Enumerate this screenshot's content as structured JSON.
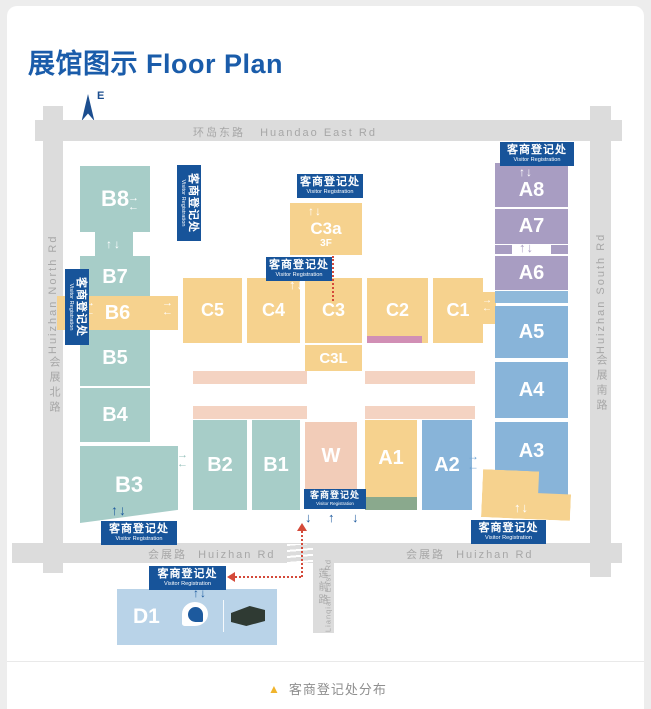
{
  "title": "展馆图示 Floor Plan",
  "compass": {
    "label": "E"
  },
  "roads": {
    "huandao": {
      "zh": "环岛东路",
      "en": "Huandao East Rd"
    },
    "huizhan_north": {
      "zh": "会展北路",
      "en": "Huizhan North Rd"
    },
    "huizhan_south": {
      "zh": "会展南路",
      "en": "Huizhan South Rd"
    },
    "huizhan": {
      "zh": "会展路",
      "en": "Huizhan Rd"
    },
    "lianqian": {
      "zh": "莲前路",
      "en": "Lianqian East Rd"
    }
  },
  "registration": {
    "zh": "客商登记处",
    "en": "Visitor Registration"
  },
  "halls": {
    "B8": "B8",
    "B7": "B7",
    "B6": "B6",
    "B5": "B5",
    "B4": "B4",
    "B3": "B3",
    "B2": "B2",
    "B1": "B1",
    "C5": "C5",
    "C4": "C4",
    "C3": "C3",
    "C2": "C2",
    "C1": "C1",
    "C3a": "C3a",
    "C3a_floor": "3F",
    "C3L": "C3L",
    "A8": "A8",
    "A7": "A7",
    "A6": "A6",
    "A5": "A5",
    "A4": "A4",
    "A3": "A3",
    "A2": "A2",
    "A1": "A1",
    "W": "W",
    "D1": "D1"
  },
  "icons": {
    "up": "↑",
    "down": "↓",
    "left": "←",
    "right": "→",
    "up_down": "↑↓",
    "legend_marker": "▲"
  },
  "legend": {
    "text": "客商登记处分布"
  },
  "colors": {
    "title_blue": "#1a5caa",
    "badge_blue": "#17549a",
    "teal": "#a7cdc8",
    "yellow": "#f6d28e",
    "purple": "#a89dc2",
    "blue": "#88b4d9",
    "salmon": "#f2ccb8",
    "light_blue_d1": "#b9d3e8",
    "road_gray": "#dcdcdc",
    "red_path": "#d44a3a",
    "green_strip": "#8aa98d",
    "mauve_strip": "#d18fb5",
    "legend_yellow": "#f0b42c"
  }
}
